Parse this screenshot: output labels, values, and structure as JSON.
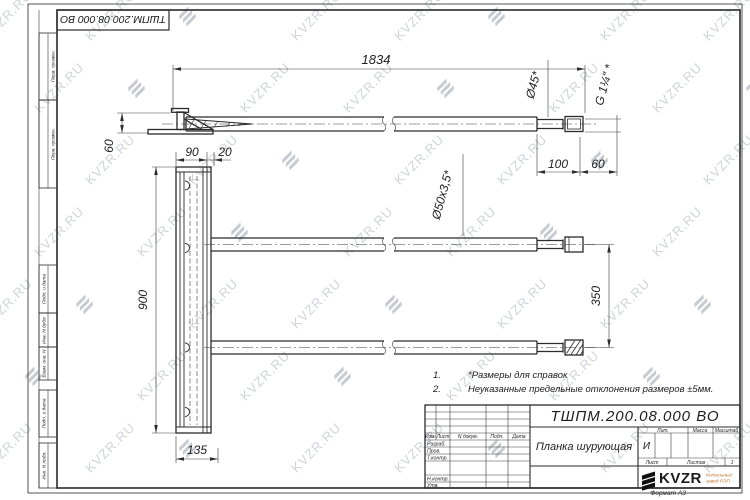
{
  "watermark": {
    "text": "KVZR.RU"
  },
  "stamp_top": "ТШПМ.200.08.000 ВО",
  "margin": {
    "boxes": [
      "Перв. примен.",
      "Перв. примен.",
      "Подп. и дата",
      "Инв. N дубл.",
      "Взам. инв. N",
      "Подп. и дата",
      "Инв. N подл."
    ]
  },
  "notes": {
    "items": [
      {
        "num": "1.",
        "text": "*Размеры для справок"
      },
      {
        "num": "2.",
        "text": "Неуказанные предельные отклонения размеров ±5мм."
      }
    ]
  },
  "dimensions": {
    "length": "1834",
    "hook_height": "60",
    "plank_width": "90",
    "offset": "20",
    "plank_height": "900",
    "plank_bottom": "135",
    "end_len": "100",
    "thread_len": "60",
    "tube_spacing": "350",
    "dia_end": "Ø45*",
    "dia_tube": "Ø50х3,5*",
    "thread": "G 1¼″ *"
  },
  "title_block": {
    "designation": "ТШПМ.200.08.000 ВО",
    "part_name": "Планка шурующая",
    "header": {
      "izm": "Изм.",
      "list": "Лист",
      "doc": "N докум.",
      "sign": "Подп.",
      "date": "Дата"
    },
    "rows": [
      "Разраб.",
      "Пров.",
      "Т.контр.",
      "Н.контр.",
      "Утв."
    ],
    "lit_label": "Лит.",
    "lit_value": "И",
    "mass_label": "Масса",
    "scale_label": "Масштаб",
    "sheet_label": "Лист",
    "sheets_label": "Листов",
    "sheets_value": "1",
    "logo": "KVZR",
    "logo_sub1": "Котельный",
    "logo_sub2": "завод РЭП",
    "format": "Формат А3"
  }
}
